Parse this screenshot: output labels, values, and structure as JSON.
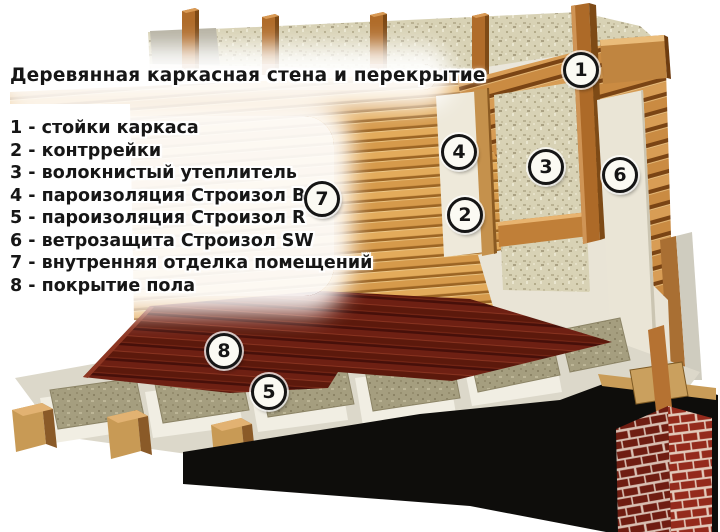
{
  "title": "Деревянная каркасная стена и перекрытие",
  "legend": {
    "items": [
      "1 - стойки каркаса",
      "2 - контррейки",
      "3 - волокнистый утеплитель",
      "4 - пароизоляция Строизол B",
      "5 - пароизоляция Строизол R",
      "6 - ветрозащита Строизол SW",
      "7 - внутренняя отделка помещений",
      "8 - покрытие пола"
    ]
  },
  "markers": [
    "1",
    "2",
    "3",
    "4",
    "5",
    "6",
    "7",
    "8"
  ],
  "colors": {
    "background": "#ffffff",
    "text": "#161616",
    "exterior_siding_wood": "#c8893f",
    "interior_paneling_wood": "#e2aa5c",
    "floor_covering_mahogany": "#6e2013",
    "fibrous_insulation": "#d7d1b4",
    "floor_insulation": "#a59e7f",
    "membrane_white": "#ece7d8",
    "frame_stud_wood": "#ad6a28",
    "brick_dark": "#6f1d12",
    "brick_light": "#942a1c",
    "foundation_black": "#0e0d0b"
  }
}
